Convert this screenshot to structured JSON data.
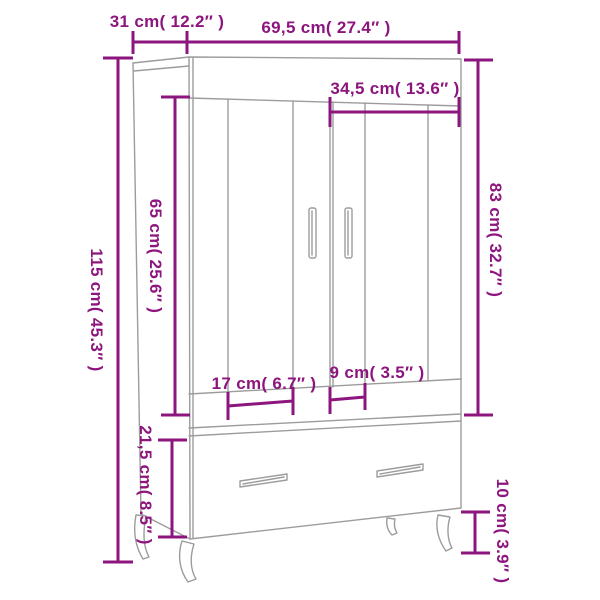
{
  "diagram": {
    "subject": "wardrobe-dimension-diagram",
    "colors": {
      "dimension_accent": "#8d157e",
      "furniture_outline": "#9c9c9c",
      "background": "#ffffff"
    },
    "dims": [
      {
        "id": "depth",
        "label": "31 cm( 12.2″ )",
        "cm": "31",
        "inches": "12.2"
      },
      {
        "id": "width",
        "label": "69,5 cm( 27.4″ )",
        "cm": "69,5",
        "inches": "27.4"
      },
      {
        "id": "door-width",
        "label": "34,5 cm( 13.6″ )",
        "cm": "34,5",
        "inches": "13.6"
      },
      {
        "id": "total-height",
        "label": "115 cm( 45.3″ )",
        "cm": "115",
        "inches": "45.3"
      },
      {
        "id": "door-height",
        "label": "65 cm( 25.6″ )",
        "cm": "65",
        "inches": "25.6"
      },
      {
        "id": "upper-section-height",
        "label": "83 cm( 32.7″ )",
        "cm": "83",
        "inches": "32.7"
      },
      {
        "id": "left-compartment-width",
        "label": "17 cm( 6.7″ )",
        "cm": "17",
        "inches": "6.7"
      },
      {
        "id": "right-compartment-width",
        "label": "9 cm( 3.5″ )",
        "cm": "9",
        "inches": "3.5"
      },
      {
        "id": "drawer-section-height",
        "label": "21,5 cm( 8.5″ )",
        "cm": "21,5",
        "inches": "8.5"
      },
      {
        "id": "leg-height",
        "label": "10 cm( 3.9″ )",
        "cm": "10",
        "inches": "3.9"
      }
    ]
  }
}
